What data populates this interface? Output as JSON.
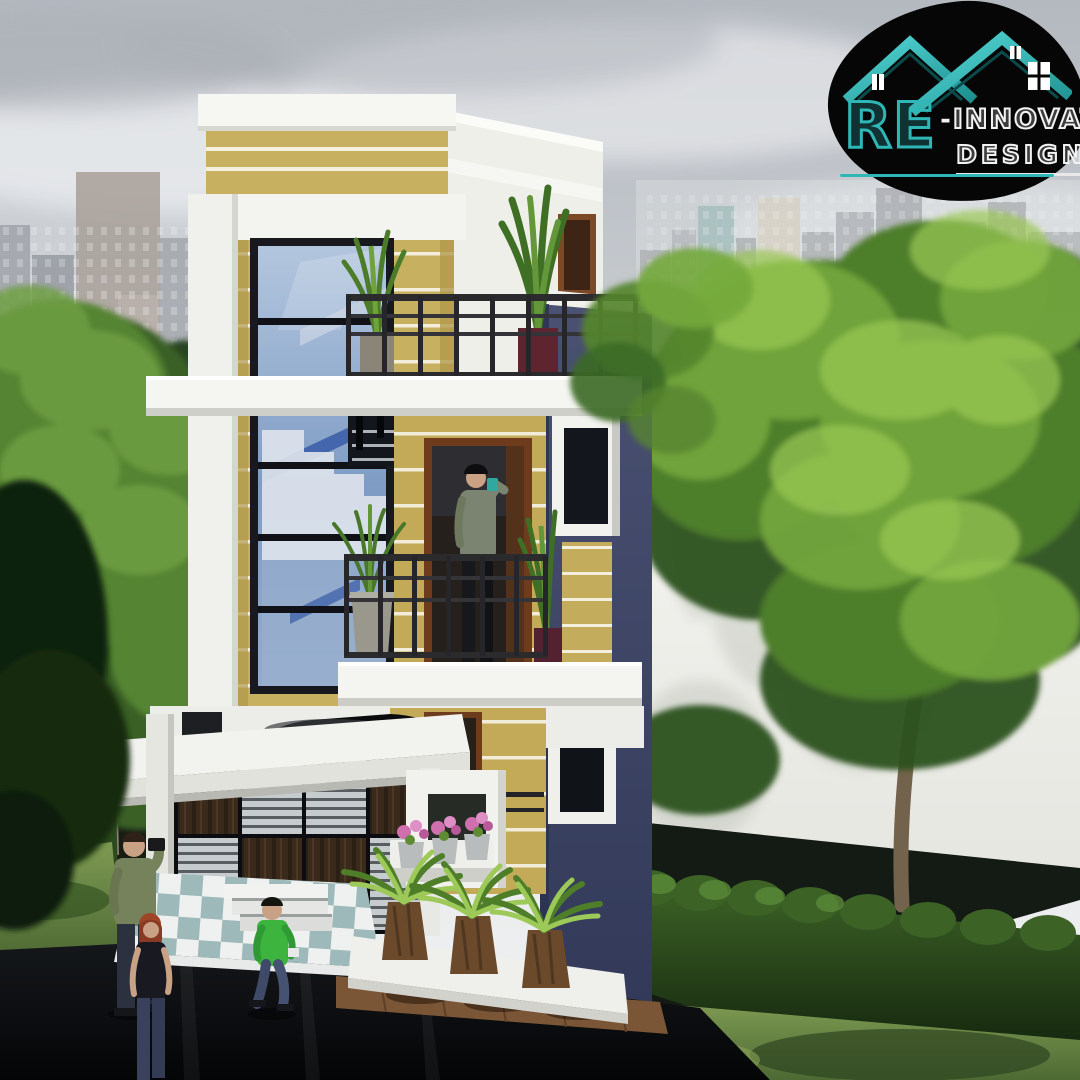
{
  "meta": {
    "canvas_width": 1080,
    "canvas_height": 1080,
    "content_type": "3d-architectural-exterior-render",
    "subject": "modern three-storey narrow house with roof terrace, balconies, garage, city skyline and trees"
  },
  "logo": {
    "re": "RE",
    "dash": "-",
    "innovate": "INNOVATE",
    "designs": "DESIGNS",
    "colors": {
      "badge_bg": "#060606",
      "roof_teal": "#2fb7b7",
      "text": "#f2f2f2"
    }
  },
  "palette": {
    "sky": "#cdd1d5",
    "facade_yellow": "#c7b060",
    "facade_white": "#f3f3f0",
    "accent_navy": "#3d4363",
    "window_glass_blue": "#8aa4c8",
    "stair_blue": "#3c5fa8",
    "tree_green": "#5d8c33",
    "hedge_green": "#233a1a",
    "road_asphalt": "#0c0e11",
    "wood_brown": "#4a3526",
    "deck_brown": "#7a5636",
    "flower_pink": "#cf6fae",
    "skin": "#c9a184"
  }
}
